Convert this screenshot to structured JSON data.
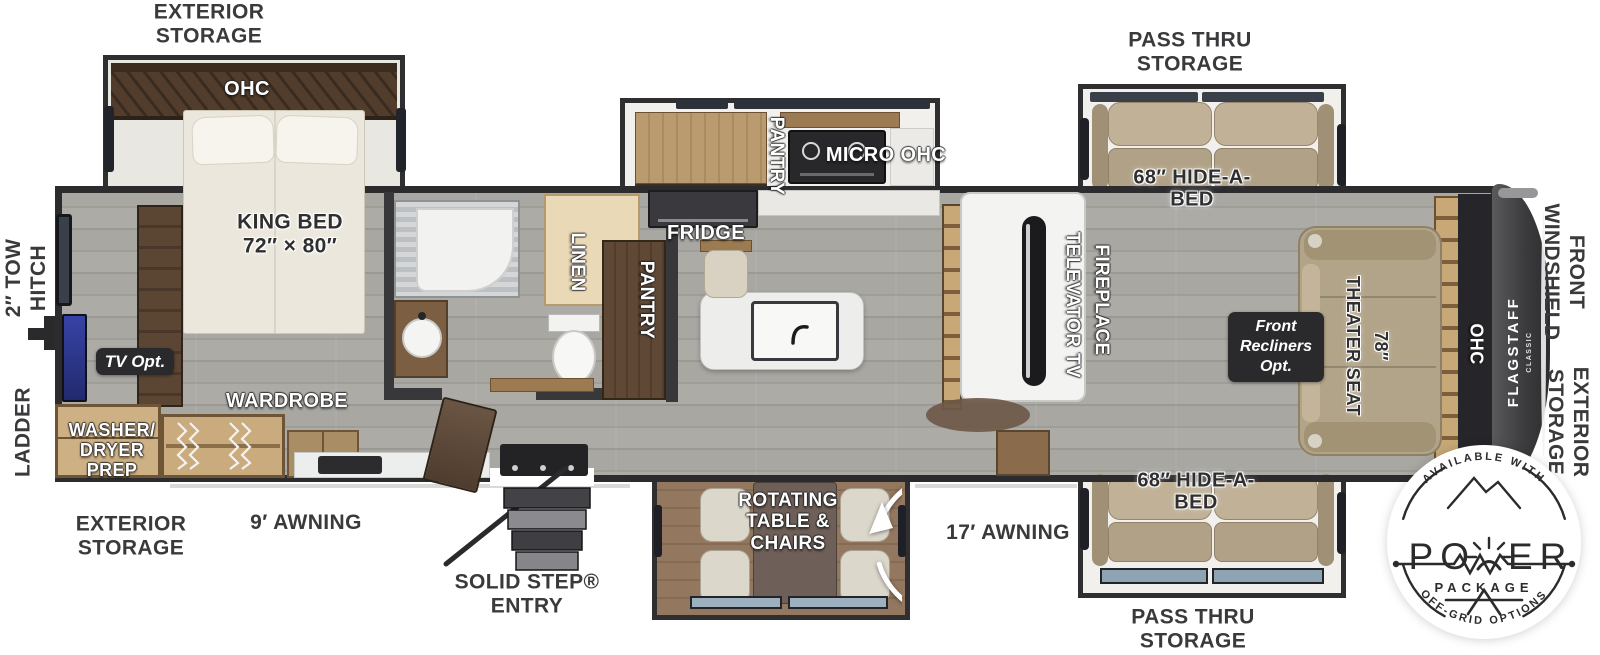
{
  "exterior": {
    "storage_top_left": "EXTERIOR\nSTORAGE",
    "pass_thru_top": "PASS THRU\nSTORAGE",
    "tow_hitch": "2″ TOW\nHITCH",
    "ladder": "LADDER",
    "storage_bottom_left": "EXTERIOR\nSTORAGE",
    "awning_9": "9′ AWNING",
    "solid_step": "SOLID STEP®\nENTRY",
    "awning_17": "17′ AWNING",
    "pass_thru_bottom": "PASS THRU\nSTORAGE",
    "front_windshield": "FRONT\nWINDSHIELD",
    "storage_right": "EXTERIOR\nSTORAGE"
  },
  "bedroom": {
    "ohc": "OHC",
    "king_bed": "KING BED\n72″ × 80″",
    "tv_opt": "TV Opt.",
    "washer_dryer": "WASHER/\nDRYER\nPREP",
    "wardrobe": "WARDROBE"
  },
  "kitchen_bath": {
    "linen": "LINEN",
    "pantry_bath": "PANTRY",
    "fridge": "FRIDGE",
    "pantry_slide": "PANTRY",
    "micro_ohc": "MICRO OHC",
    "rotating_table": "ROTATING\nTABLE &\nCHAIRS"
  },
  "living": {
    "televator_tv": "TELEVATOR TV",
    "fireplace": "FIREPLACE",
    "hide_a_bed_top": "68″ HIDE-A-\nBED",
    "hide_a_bed_bottom": "68″ HIDE-A-\nBED",
    "front_recliners": "Front\nRecliners\nOpt.",
    "theater_seat": "78″\nTHEATER SEAT",
    "ohc_front": "OHC",
    "flagstaff": "FLAGSTAFF",
    "classic": "CLASSIC"
  },
  "badge": {
    "available_with": "AVAILABLE WITH",
    "power_left": "PO",
    "power_right": "ER",
    "package": "PACKAGE",
    "off_grid": "OFF-GRID OPTIONS"
  },
  "colors": {
    "wall": "#2f2f31",
    "floor_gray": "#a5a4a0",
    "wood_light": "#c9ab7e",
    "wood_mid": "#9c7b53",
    "wood_dark": "#55402e",
    "sofa_tan": "#b3a58a",
    "tv_blue": "#2f3a95",
    "cap_gray": "#47474a",
    "option_box": "#2a2a2c"
  }
}
